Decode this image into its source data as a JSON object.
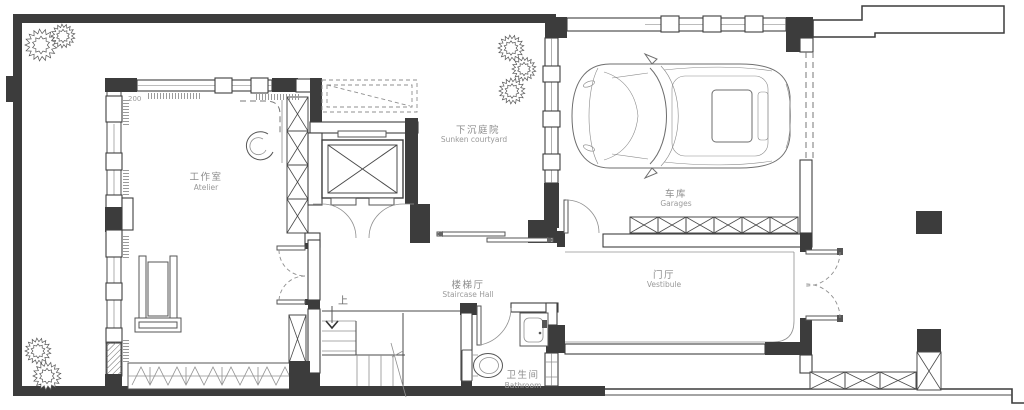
{
  "plan": {
    "rooms": [
      {
        "key": "atelier",
        "zh": "工作室",
        "en": "Atelier"
      },
      {
        "key": "sunken_courtyard",
        "zh": "下沉庭院",
        "en": "Sunken courtyard"
      },
      {
        "key": "garage",
        "zh": "车库",
        "en": "Garages"
      },
      {
        "key": "staircase_hall",
        "zh": "楼梯厅",
        "en": "Staircase Hall"
      },
      {
        "key": "vestibule",
        "zh": "门厅",
        "en": "Vestibule"
      },
      {
        "key": "bathroom",
        "zh": "卫生间",
        "en": "Bathroom"
      }
    ],
    "annotations": {
      "stair_direction": "上",
      "dimension": "200"
    },
    "colors": {
      "wall": "#3c3c3c",
      "line": "#4a4a4a",
      "label": "#8f8f8f",
      "background": "#ffffff"
    }
  }
}
